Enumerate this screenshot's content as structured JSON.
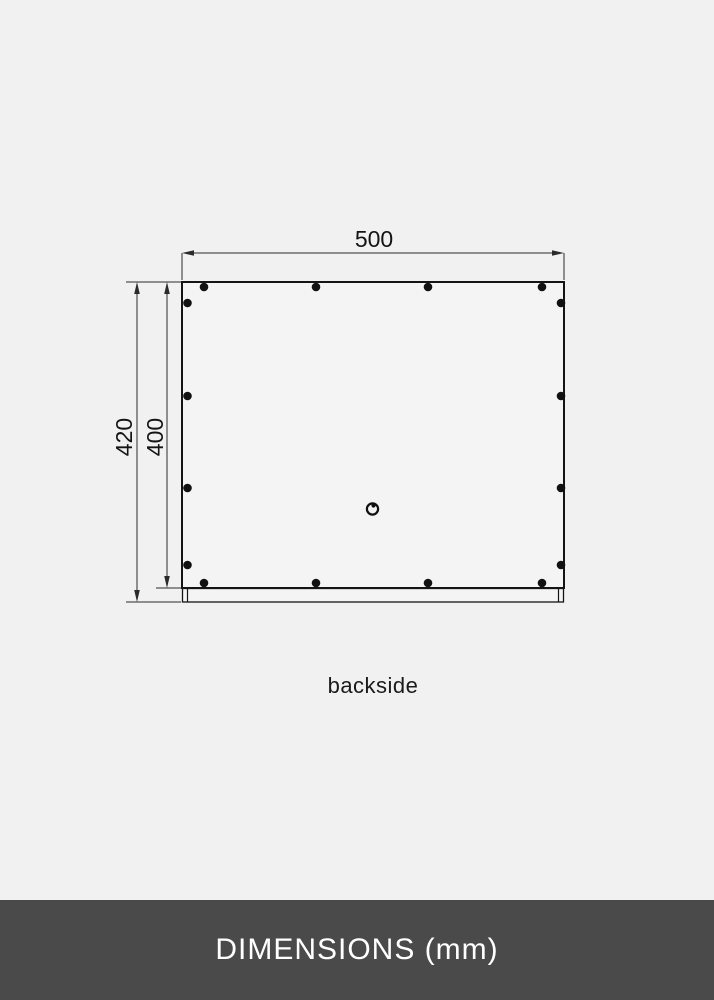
{
  "page": {
    "background_color": "#f1f1f2",
    "line_color": "#1a1a1a",
    "hole_color": "#111111"
  },
  "diagram": {
    "view": "backside",
    "width_dimension": "500",
    "total_height_dimension": "420",
    "panel_height_dimension": "400",
    "caption": "backside",
    "mounting_holes_top": 4,
    "mounting_holes_bottom": 4,
    "mounting_holes_left": 4,
    "mounting_holes_right": 4,
    "keyhole_icon": "keyhole-hanger-icon"
  },
  "footer": {
    "title": "DIMENSIONS (mm)",
    "background_color": "#4a4a4a",
    "text_color": "#ffffff"
  }
}
